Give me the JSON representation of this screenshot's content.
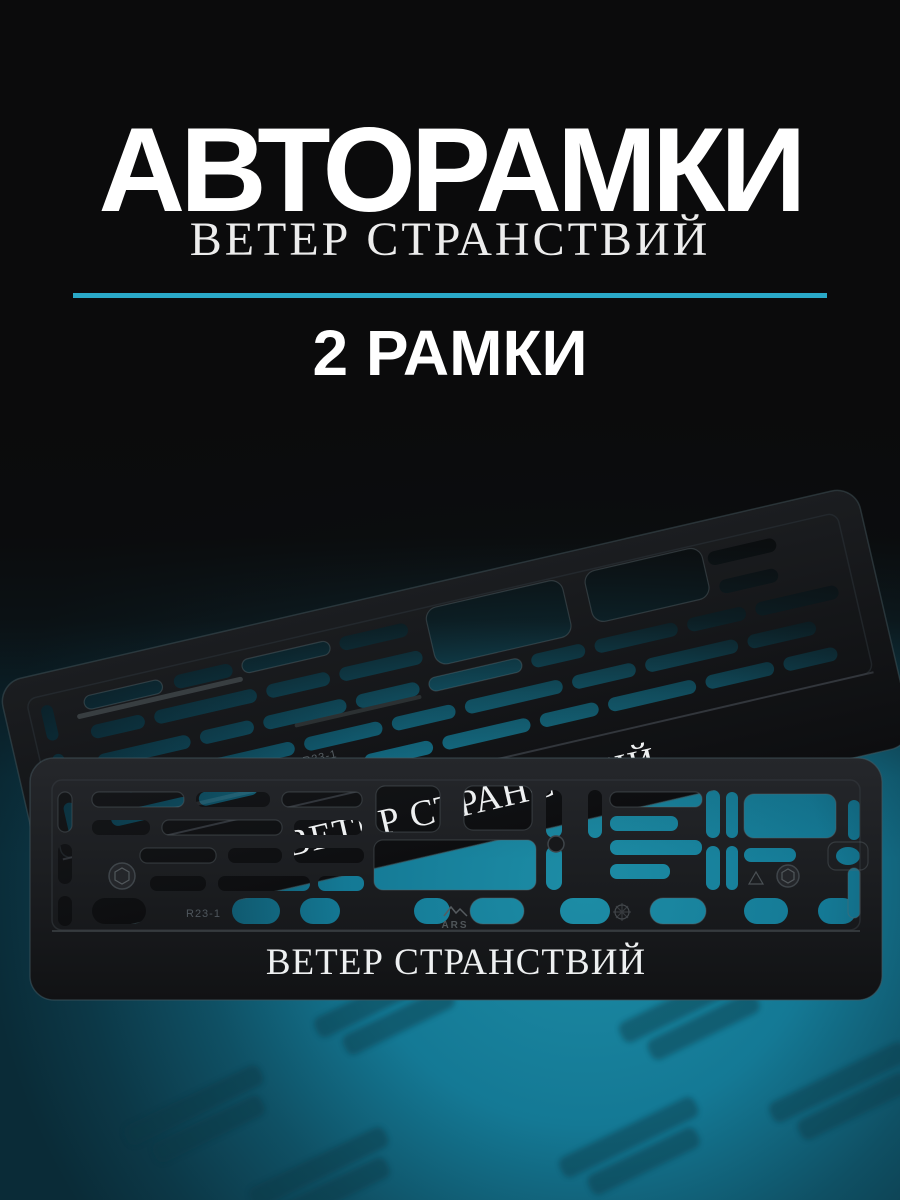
{
  "header": {
    "title": "АВТОРАМКИ"
  },
  "product": {
    "name": "ВЕТЕР СТРАНСТВИЙ",
    "quantity": "2 РАМКИ"
  },
  "divider": {
    "color": "#2aa9c8"
  },
  "photo": {
    "front_frame_text": "ВЕТЕР СТРАНСТВИЙ",
    "rear_frame_text": "ВЕТЕР СТРАНСТВИЙ",
    "front_marking": "R23-1",
    "rear_marking": "R23-1",
    "brand_logo": "ARS",
    "colors": {
      "background": "#0b0b0c",
      "teal_center": "#1d8da6",
      "teal_mid": "#147995",
      "teal_edge": "#0a2b37",
      "plastic_front": "#202226",
      "plastic_rear": "#1b1d20",
      "frame_text": "#eef0f1"
    }
  }
}
